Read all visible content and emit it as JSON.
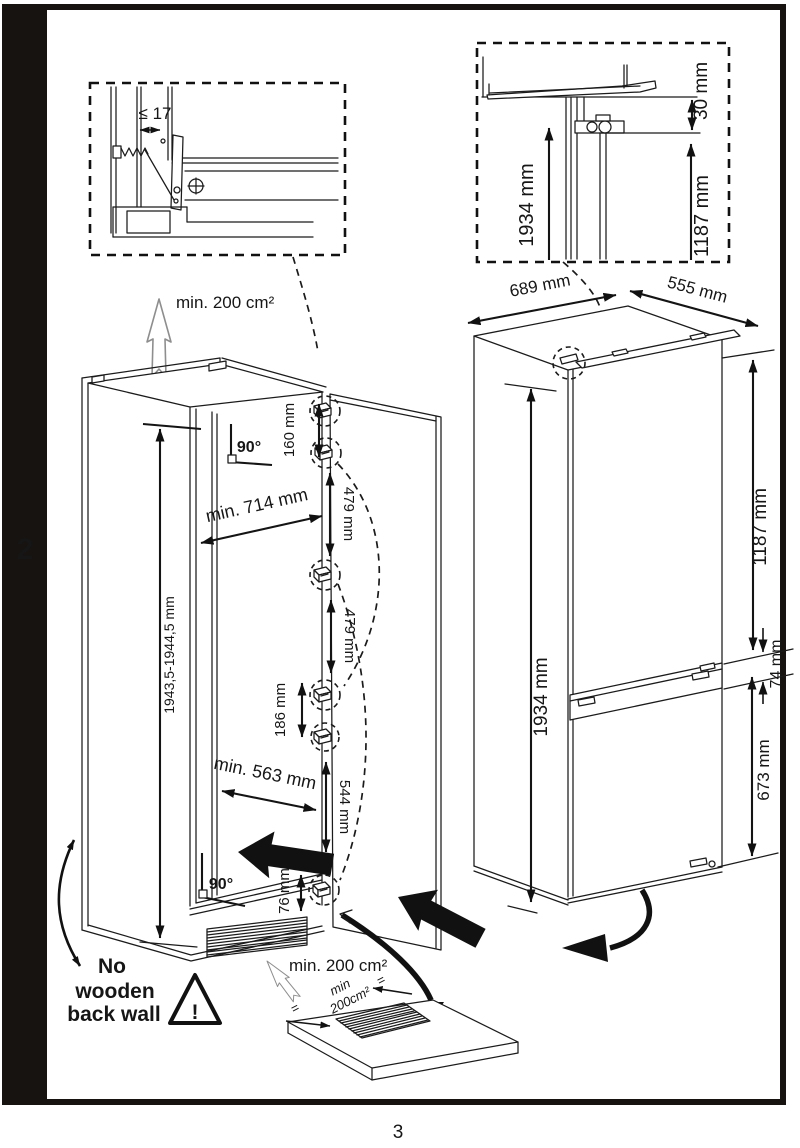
{
  "page": {
    "section_tab": "2",
    "page_number": "3"
  },
  "hinge_detail": {
    "panel_gap": "≤ 17"
  },
  "top_detail": {
    "height_total": "1934 mm",
    "top_clearance": "30 mm",
    "upper_height": "1187 mm"
  },
  "cabinet": {
    "vent_top": "min. 200 cm²",
    "angle_top": "90°",
    "width_top": "min. 714 mm",
    "height_range": "1943,5-1944,5 mm",
    "hinge_top_offset": "160 mm",
    "hinge_gap_1": "479 mm",
    "hinge_gap_2": "479 mm",
    "hinge_gap_3": "186 mm",
    "door_lower_len": "544 mm",
    "hinge_bottom_offset": "76 mm",
    "width_bottom": "min. 563 mm",
    "angle_bottom": "90°",
    "no_wood_1": "No",
    "no_wood_2": "wooden",
    "no_wood_3": "back wall",
    "warning_mark": "!",
    "vent_bottom": "min. 200 cm²",
    "plinth_vent_1": "min",
    "plinth_vent_2": "200cm²",
    "center_mark_left": "=",
    "center_mark_right": "="
  },
  "appliance": {
    "depth": "689 mm",
    "width": "555 mm",
    "height": "1934 mm",
    "upper_section": "1187 mm",
    "hinge_gap": "74 mm",
    "lower_section": "673 mm"
  }
}
